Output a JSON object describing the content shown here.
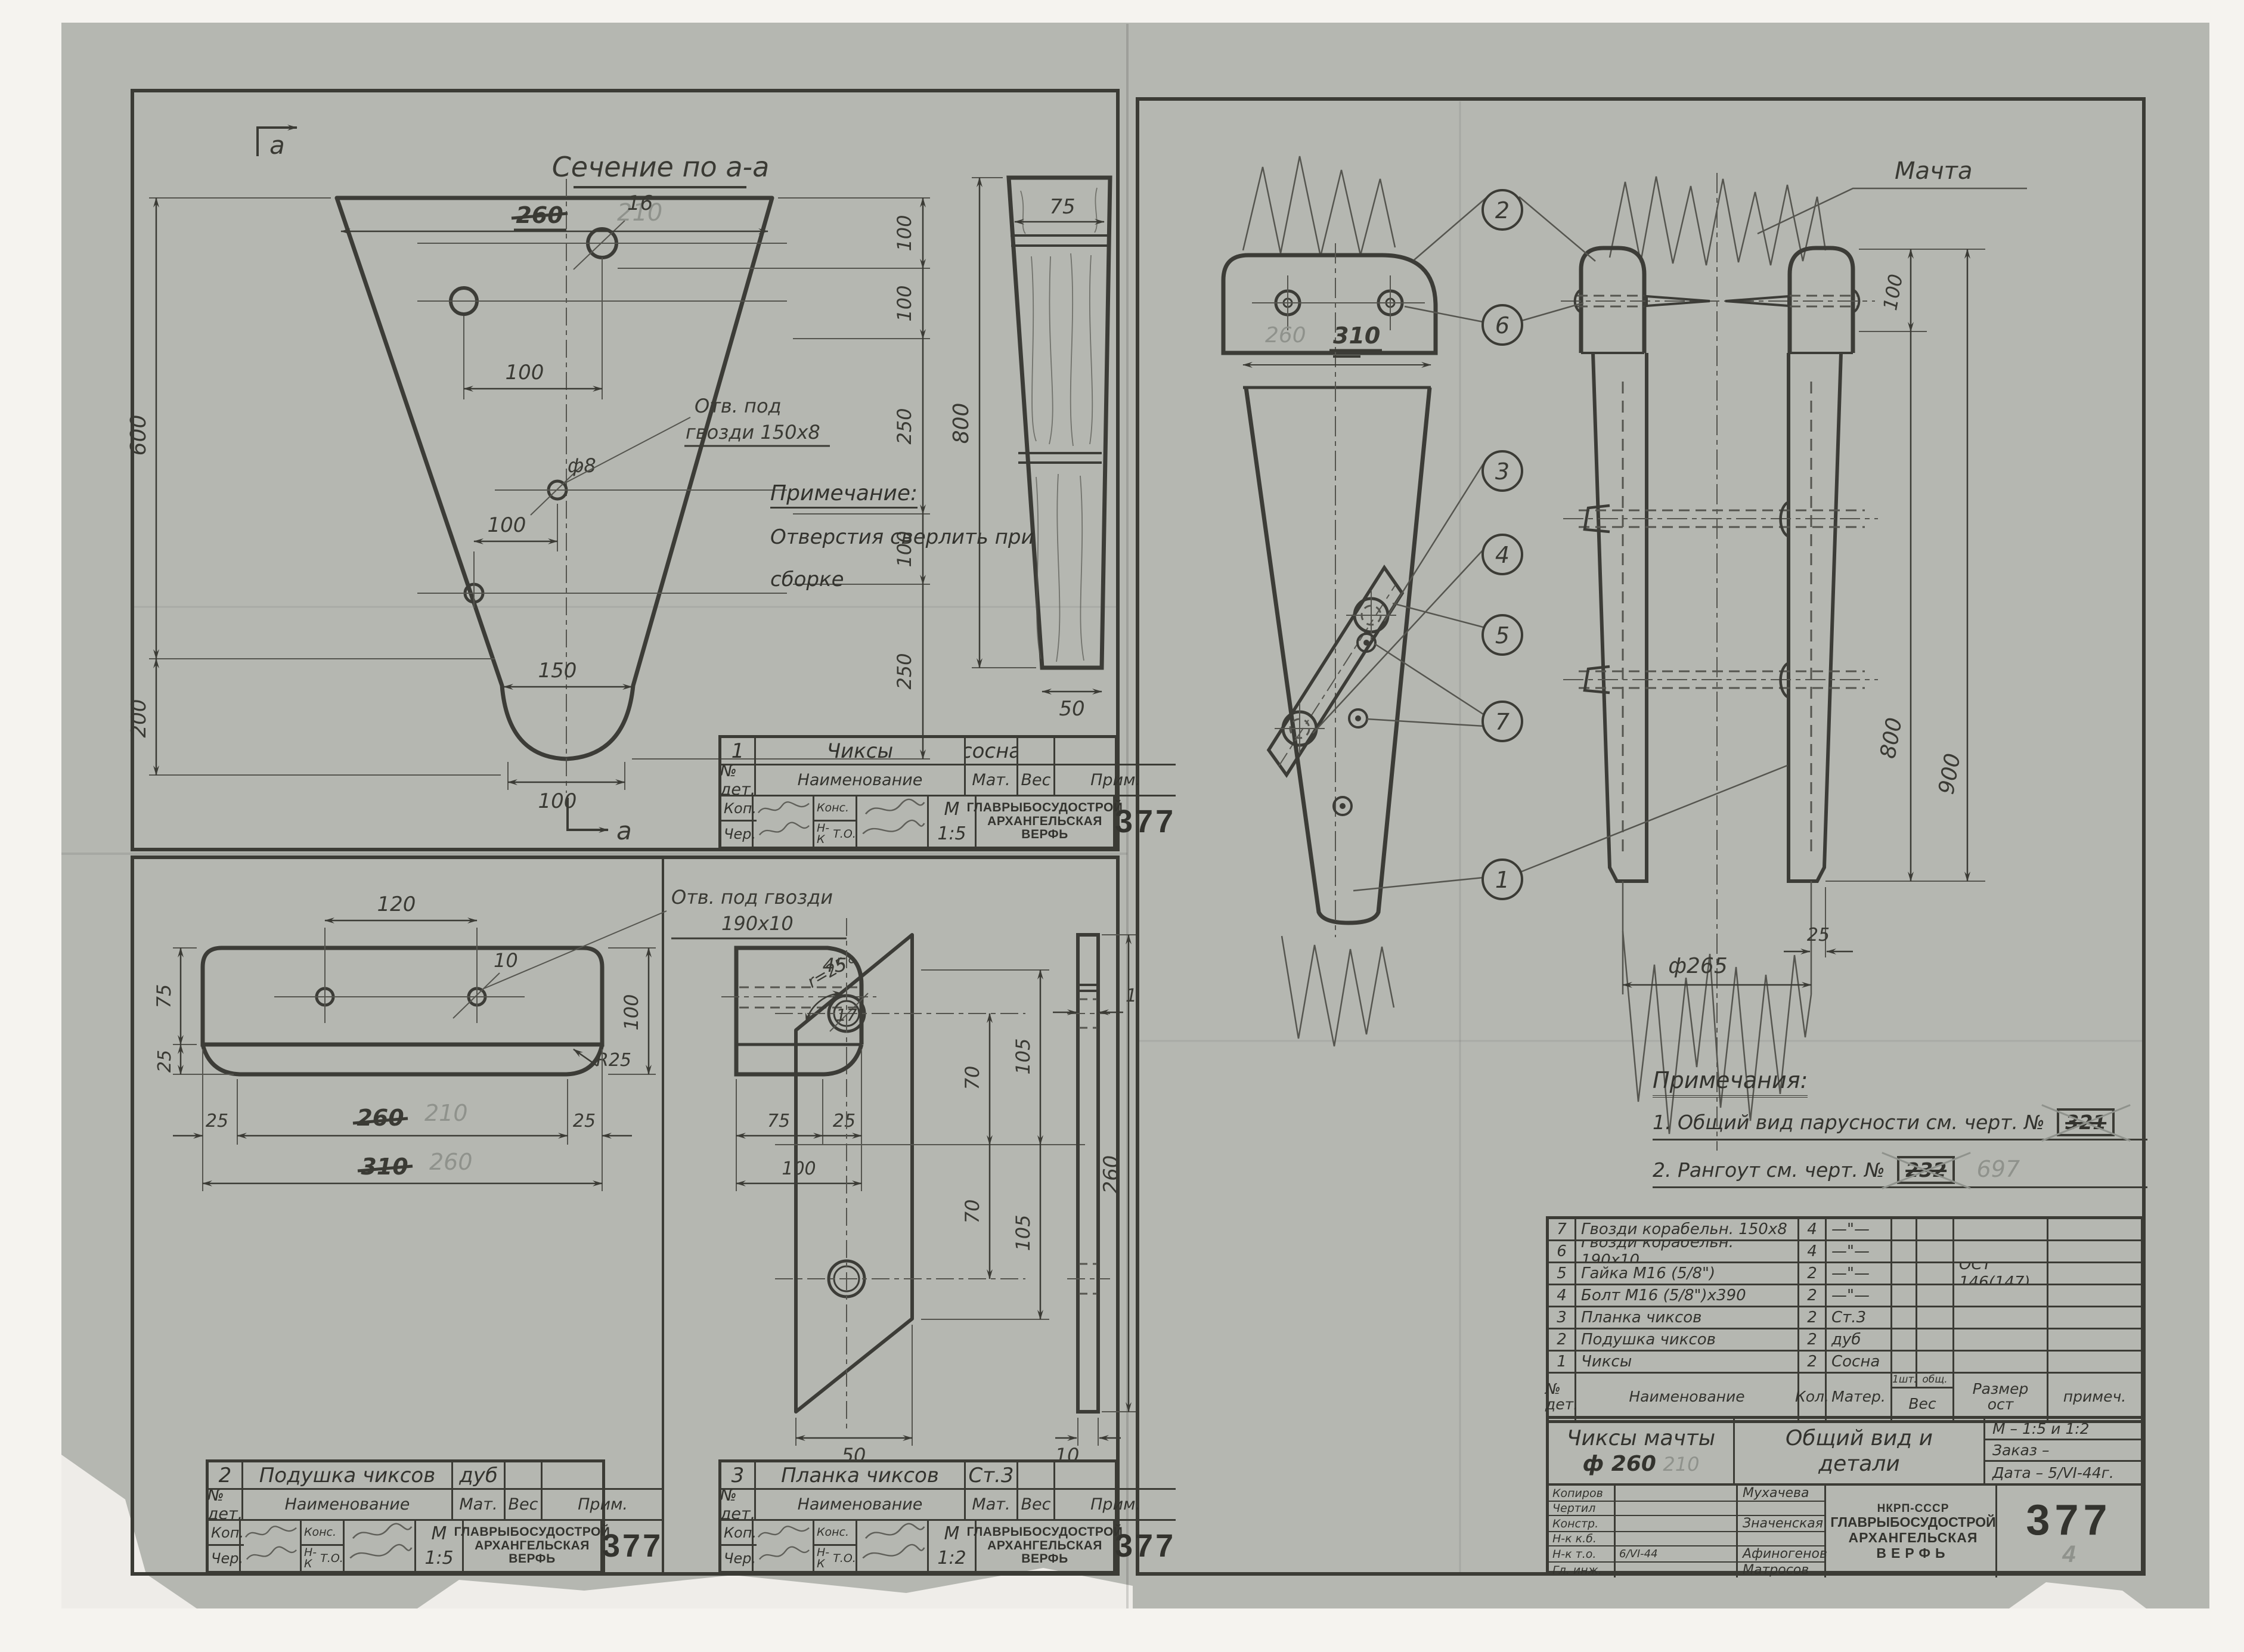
{
  "sheet": {
    "section_title": "Сечение по а-а",
    "section_letter_top": "а",
    "section_letter_bottom": "а",
    "mast_label": "Мачта",
    "note_left": {
      "title": "Примечание:",
      "line1": "Отверстия сверлить при",
      "line2": "сборке"
    },
    "notes_right": {
      "title": "Примечания:",
      "item1": "1. Общий вид парусности см. черт. №",
      "item1_num": "321",
      "item2": "2. Рангоут  см. черт.  №",
      "item2_num": "232",
      "item2_num_pencil": "697"
    }
  },
  "dims": {
    "cheek": {
      "w_top_ink": "260",
      "w_top_pencil": "210",
      "hole_big": "16",
      "off1": "100",
      "hole_small": "ф8",
      "note1": "Отв. под",
      "note2": "гвозди 150х8",
      "off2": "100",
      "w_mid": "150",
      "w_bot": "100",
      "h1": "600",
      "h2": "200",
      "r1": "100",
      "r2": "100",
      "r3": "250",
      "r4": "100",
      "r5": "250"
    },
    "section": {
      "w_top": "75",
      "h": "800",
      "w_bot": "50"
    },
    "cushion": {
      "d_holes": "120",
      "hole": "10",
      "note1": "Отв. под гвозди",
      "note2": "190х10",
      "left1": "75",
      "left2": "25",
      "right1": "100",
      "fillet": "R25",
      "b1": "25",
      "b2_ink": "260",
      "b2_pencil": "210",
      "b3": "25",
      "b4_ink": "310",
      "b4_pencil": "260",
      "side_r": "r=25",
      "s1": "75",
      "s2": "25",
      "s3": "100"
    },
    "plank": {
      "angle": "45°",
      "hole": "17",
      "v1": "70",
      "v2": "70",
      "v3": "105",
      "v4": "105",
      "w": "50",
      "t": "1",
      "h": "260",
      "sw": "10"
    },
    "assembly": {
      "w_pencil": "260",
      "w_ink": "310",
      "top": "100",
      "h_inner": "800",
      "h_outer": "900",
      "dia": "ф265",
      "cheek": "25"
    }
  },
  "callouts": [
    "1",
    "2",
    "3",
    "4",
    "5",
    "6",
    "7"
  ],
  "parts": {
    "hdr": {
      "no": "№ дет.",
      "name": "Наименование",
      "qty": "Кол.",
      "mat": "Матер.",
      "wt_a": "1шт.",
      "wt_b": "общ.",
      "wt": "Вес",
      "razm1": "Размер",
      "razm2": "ост",
      "prim": "примеч."
    },
    "rows": [
      {
        "no": "7",
        "name": "Гвозди корабельн. 150х8",
        "qty": "4",
        "mat": "—\"—",
        "razm": "",
        "prim": ""
      },
      {
        "no": "6",
        "name": "Гвозди корабельн. 190х10",
        "qty": "4",
        "mat": "—\"—",
        "razm": "",
        "prim": ""
      },
      {
        "no": "5",
        "name": "Гайка М16 (5/8\")",
        "qty": "2",
        "mat": "—\"—",
        "razm": "ОСТ 146(147)",
        "prim": ""
      },
      {
        "no": "4",
        "name": "Болт М16 (5/8\")х390",
        "qty": "2",
        "mat": "—\"—",
        "razm": "",
        "prim": ""
      },
      {
        "no": "3",
        "name": "Планка чиксов",
        "qty": "2",
        "mat": "Ст.3",
        "razm": "",
        "prim": ""
      },
      {
        "no": "2",
        "name": "Подушка чиксов",
        "qty": "2",
        "mat": "дуб",
        "razm": "",
        "prim": ""
      },
      {
        "no": "1",
        "name": "Чиксы",
        "qty": "2",
        "mat": "Сосна",
        "razm": "",
        "prim": ""
      }
    ]
  },
  "tb_small": {
    "hdr": {
      "no": "№ дет.",
      "name": "Наименование",
      "mat": "Мат.",
      "wt": "Вес",
      "prim": "Прим."
    },
    "labels": {
      "kop": "Коп.",
      "cher": "Чер.",
      "kons": "Конс.",
      "nk1": "Н-К",
      "nk2": "Т.О.",
      "m": "М"
    },
    "org": [
      "ГЛАВРЫБОСУДОСТРОЙ",
      "АРХАНГЕЛЬСКАЯ",
      "ВЕРФЬ"
    ],
    "num": "377",
    "blocks": [
      {
        "no": "1",
        "name": "Чиксы",
        "mat": "сосна",
        "scale": "1:5"
      },
      {
        "no": "2",
        "name": "Подушка чиксов",
        "mat": "дуб",
        "scale": "1:5"
      },
      {
        "no": "3",
        "name": "Планка чиксов",
        "mat": "Ст.3",
        "scale": "1:2"
      }
    ]
  },
  "tb_main": {
    "title1": "Чиксы мачты",
    "title1b": "ф 260",
    "title1_pencil": "210",
    "title2a": "Общий вид и",
    "title2b": "детали",
    "scale": "М – 1:5 и 1:2",
    "order": "Заказ –",
    "date": "Дата – 5/VI-44г.",
    "roles": [
      "Копиров",
      "Чертил",
      "Констр.",
      "Н-к к.б.",
      "Н-к т.о.",
      "Гл. инж."
    ],
    "names": [
      "Мухачева",
      "",
      "Значенская",
      "",
      "Афиногенов",
      "Матросов"
    ],
    "sig_date": "6/VI-44",
    "org": [
      "НКРП-СССР",
      "ГЛАВРЫБОСУДОСТРОЙ",
      "АРХАНГЕЛЬСКАЯ",
      "ВЕРФЬ"
    ],
    "monogram": "АСВ",
    "num": "377",
    "num_pencil": "4"
  }
}
